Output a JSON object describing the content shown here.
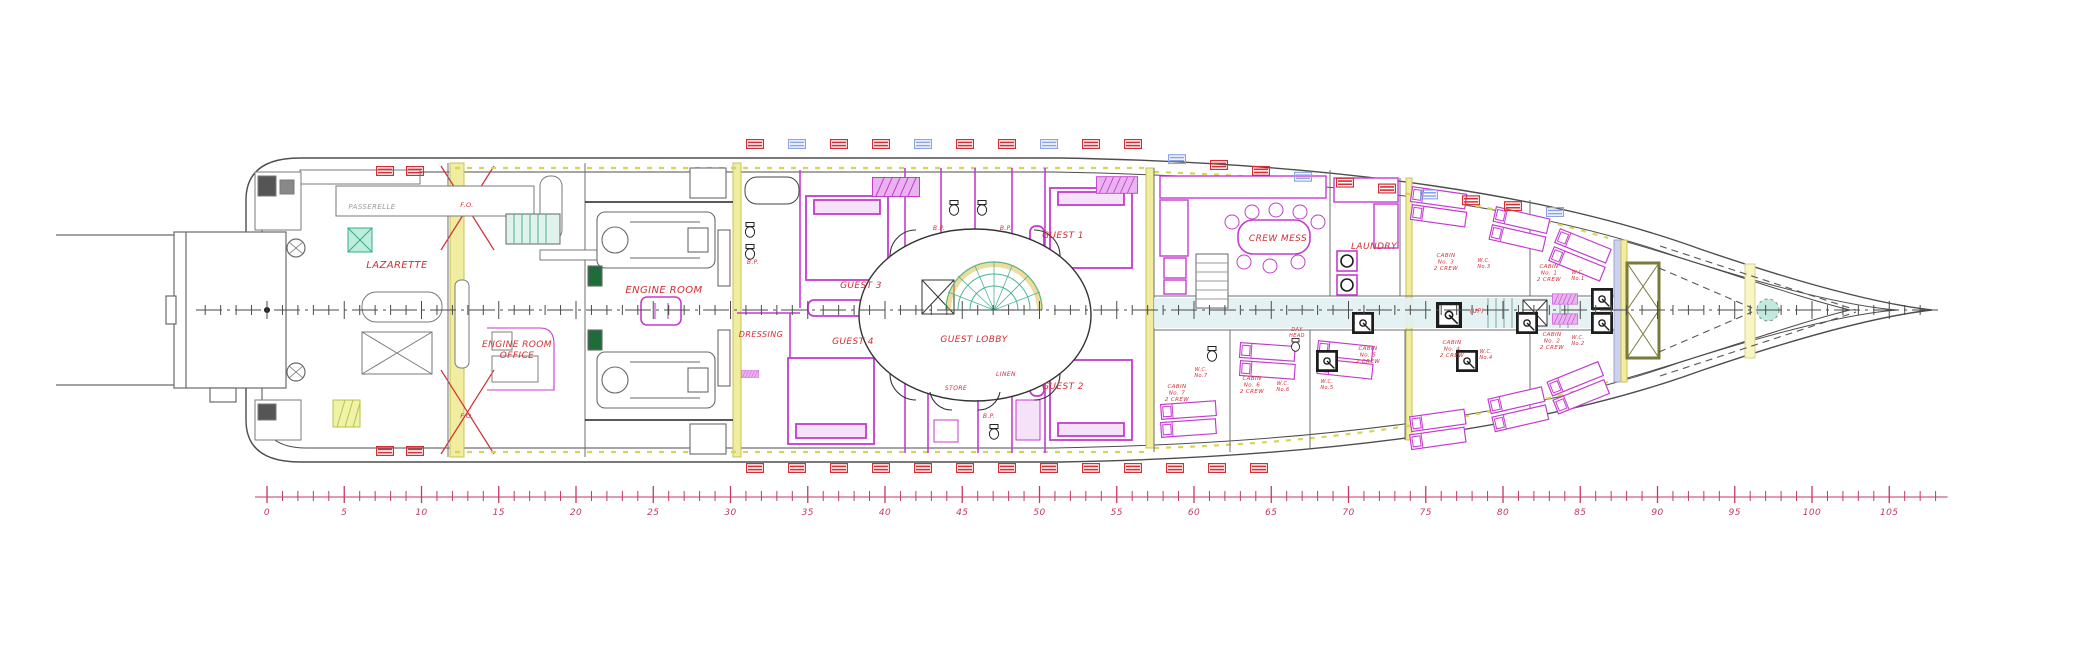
{
  "document": {
    "type": "yacht-lower-deck-general-arrangement-plan",
    "background": "#ffffff"
  },
  "colors": {
    "hull": "#4d4d4d",
    "structure": "#8a8a8a",
    "magenta": "#c43bd0",
    "magenta_fill": "#d45ade",
    "red_label": "#d12f35",
    "ruler_red": "#c23a5e",
    "tank_yellow": "#f0eda0",
    "tank_border": "#c8c455",
    "teal": "#7fd0bd",
    "pale_corridor": "#e2f1f3",
    "lavender": "#cdd0ee",
    "fitting_blue": "#8ca4e4",
    "black_unit": "#1d1d1d"
  },
  "labels": [
    {
      "lines": [
        "LAZARETTE"
      ],
      "x": 397,
      "y": 268,
      "fs": 10
    },
    {
      "lines": [
        "PASSERELLE"
      ],
      "x": 372,
      "y": 209,
      "fs": 7,
      "color": "#999999"
    },
    {
      "lines": [
        "ENGINE ROOM",
        "OFFICE"
      ],
      "x": 517,
      "y": 347,
      "fs": 9,
      "lh": 11
    },
    {
      "lines": [
        "ENGINE ROOM"
      ],
      "x": 664,
      "y": 293,
      "fs": 10
    },
    {
      "lines": [
        "DRESSING"
      ],
      "x": 761,
      "y": 337,
      "fs": 8
    },
    {
      "lines": [
        "GUEST 3"
      ],
      "x": 861,
      "y": 288,
      "fs": 9
    },
    {
      "lines": [
        "GUEST 4"
      ],
      "x": 853,
      "y": 344,
      "fs": 9
    },
    {
      "lines": [
        "GUEST LOBBY"
      ],
      "x": 974,
      "y": 342,
      "fs": 9
    },
    {
      "lines": [
        "GUEST 1"
      ],
      "x": 1063,
      "y": 238,
      "fs": 9
    },
    {
      "lines": [
        "GUEST 2"
      ],
      "x": 1063,
      "y": 389,
      "fs": 9
    },
    {
      "lines": [
        "B.P."
      ],
      "x": 939,
      "y": 230,
      "fs": 6
    },
    {
      "lines": [
        "B.P."
      ],
      "x": 1006,
      "y": 230,
      "fs": 6
    },
    {
      "lines": [
        "B.P."
      ],
      "x": 753,
      "y": 264,
      "fs": 6
    },
    {
      "lines": [
        "B.P."
      ],
      "x": 989,
      "y": 418,
      "fs": 6
    },
    {
      "lines": [
        "STORE"
      ],
      "x": 956,
      "y": 390,
      "fs": 6
    },
    {
      "lines": [
        "LINEN"
      ],
      "x": 1006,
      "y": 376,
      "fs": 6
    },
    {
      "lines": [
        "F.O."
      ],
      "x": 467,
      "y": 207,
      "fs": 6.5
    },
    {
      "lines": [
        "F.O."
      ],
      "x": 467,
      "y": 418,
      "fs": 6.5
    },
    {
      "lines": [
        "CREW MESS"
      ],
      "x": 1278,
      "y": 241,
      "fs": 9
    },
    {
      "lines": [
        "LAUNDRY"
      ],
      "x": 1374,
      "y": 249,
      "fs": 9
    },
    {
      "lines": [
        "CABIN",
        "No. 3",
        "2 CREW"
      ],
      "x": 1446,
      "y": 257,
      "fs": 5.5,
      "lh": 6.5
    },
    {
      "lines": [
        "CABIN",
        "No. 1",
        "2 CREW"
      ],
      "x": 1549,
      "y": 268,
      "fs": 5.5,
      "lh": 6.5
    },
    {
      "lines": [
        "CABIN",
        "No. 2",
        "2 CREW"
      ],
      "x": 1552,
      "y": 336,
      "fs": 5.5,
      "lh": 6.5
    },
    {
      "lines": [
        "CABIN",
        "No. 4",
        "2 CREW"
      ],
      "x": 1452,
      "y": 344,
      "fs": 5.5,
      "lh": 6.5
    },
    {
      "lines": [
        "CABIN",
        "No. 5",
        "2 CREW"
      ],
      "x": 1368,
      "y": 350,
      "fs": 5.5,
      "lh": 6.5
    },
    {
      "lines": [
        "CABIN",
        "No. 6",
        "2 CREW"
      ],
      "x": 1252,
      "y": 380,
      "fs": 5.5,
      "lh": 6.5
    },
    {
      "lines": [
        "CABIN",
        "No. 7",
        "2 CREW"
      ],
      "x": 1177,
      "y": 388,
      "fs": 5.5,
      "lh": 6.5
    },
    {
      "lines": [
        "W.C.",
        "No.3"
      ],
      "x": 1484,
      "y": 262,
      "fs": 5,
      "lh": 6
    },
    {
      "lines": [
        "W.C.",
        "No.1"
      ],
      "x": 1578,
      "y": 274,
      "fs": 5,
      "lh": 6
    },
    {
      "lines": [
        "W.C.",
        "No.2"
      ],
      "x": 1578,
      "y": 339,
      "fs": 5,
      "lh": 6
    },
    {
      "lines": [
        "W.C.",
        "No.4"
      ],
      "x": 1486,
      "y": 353,
      "fs": 5,
      "lh": 6
    },
    {
      "lines": [
        "W.C.",
        "No.5"
      ],
      "x": 1327,
      "y": 383,
      "fs": 5,
      "lh": 6
    },
    {
      "lines": [
        "W.C.",
        "No.6"
      ],
      "x": 1283,
      "y": 385,
      "fs": 5,
      "lh": 6
    },
    {
      "lines": [
        "W.C.",
        "No.7"
      ],
      "x": 1201,
      "y": 371,
      "fs": 5,
      "lh": 6
    },
    {
      "lines": [
        "DAY",
        "HEAD"
      ],
      "x": 1297,
      "y": 331,
      "fs": 5,
      "lh": 6
    },
    {
      "lines": [
        "(UP)"
      ],
      "x": 1477,
      "y": 313,
      "fs": 6
    }
  ],
  "ruler": {
    "start": 0,
    "end": 105,
    "label_step": 5,
    "minor_step": 1,
    "minor_end": 108,
    "labels": [
      "0",
      "5",
      "10",
      "15",
      "20",
      "25",
      "30",
      "35",
      "40",
      "45",
      "50",
      "55",
      "60",
      "65",
      "70",
      "75",
      "80",
      "85",
      "90",
      "95",
      "100",
      "105"
    ]
  }
}
